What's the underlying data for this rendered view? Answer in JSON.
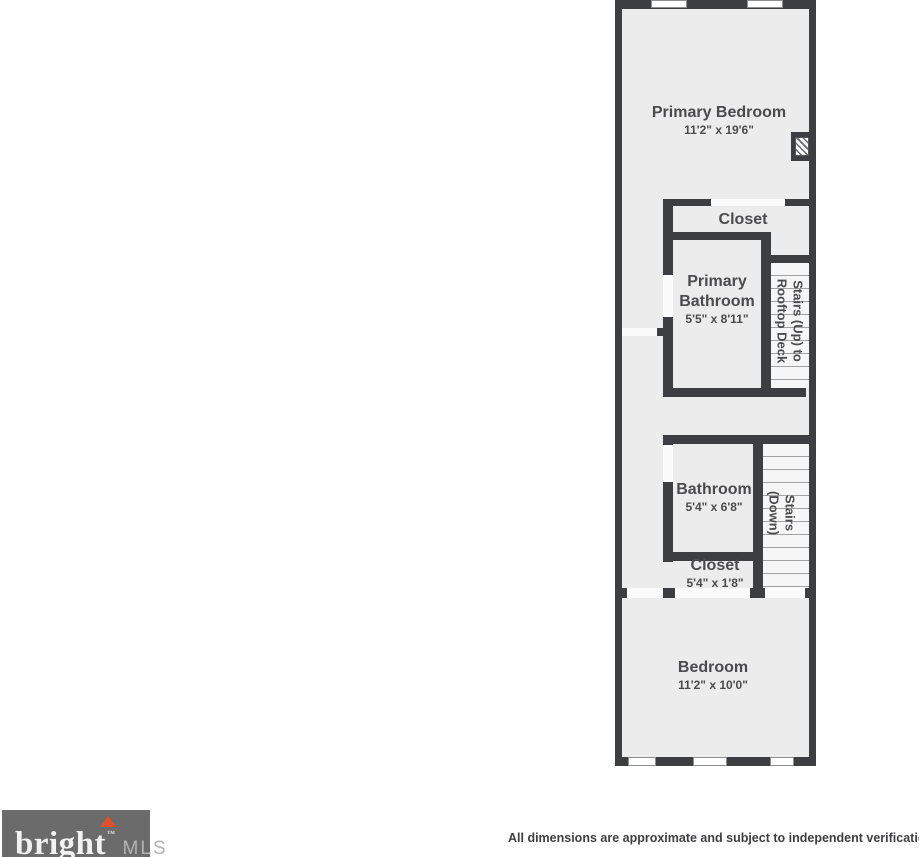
{
  "plan": {
    "primary_bedroom": {
      "name": "Primary Bedroom",
      "dims": "11'2\" x 19'6\""
    },
    "closet_upper": {
      "name": "Closet"
    },
    "primary_bathroom": {
      "name": "Primary Bathroom",
      "dims": "5'5\" x 8'11\""
    },
    "stairs_up": {
      "line1": "Stairs (Up) to",
      "line2": "Rooftop Deck"
    },
    "bathroom": {
      "name": "Bathroom",
      "dims": "5'4\" x 6'8\""
    },
    "stairs_down": {
      "line1": "Stairs",
      "line2": "(Down)"
    },
    "closet_lower": {
      "name": "Closet",
      "dims": "5'4\" x 1'8\""
    },
    "bedroom": {
      "name": "Bedroom",
      "dims": "11'2\" x 10'0\""
    }
  },
  "footer": {
    "logo": {
      "brand": "bright",
      "trademark": "™",
      "suffix": "MLS"
    },
    "disclaimer": "All dimensions are approximate and subject to independent verification"
  },
  "colors": {
    "wall": "#3d3e40",
    "floor": "#ececec",
    "accent": "#e2502a",
    "logo_bg": "#6b6b6b"
  }
}
